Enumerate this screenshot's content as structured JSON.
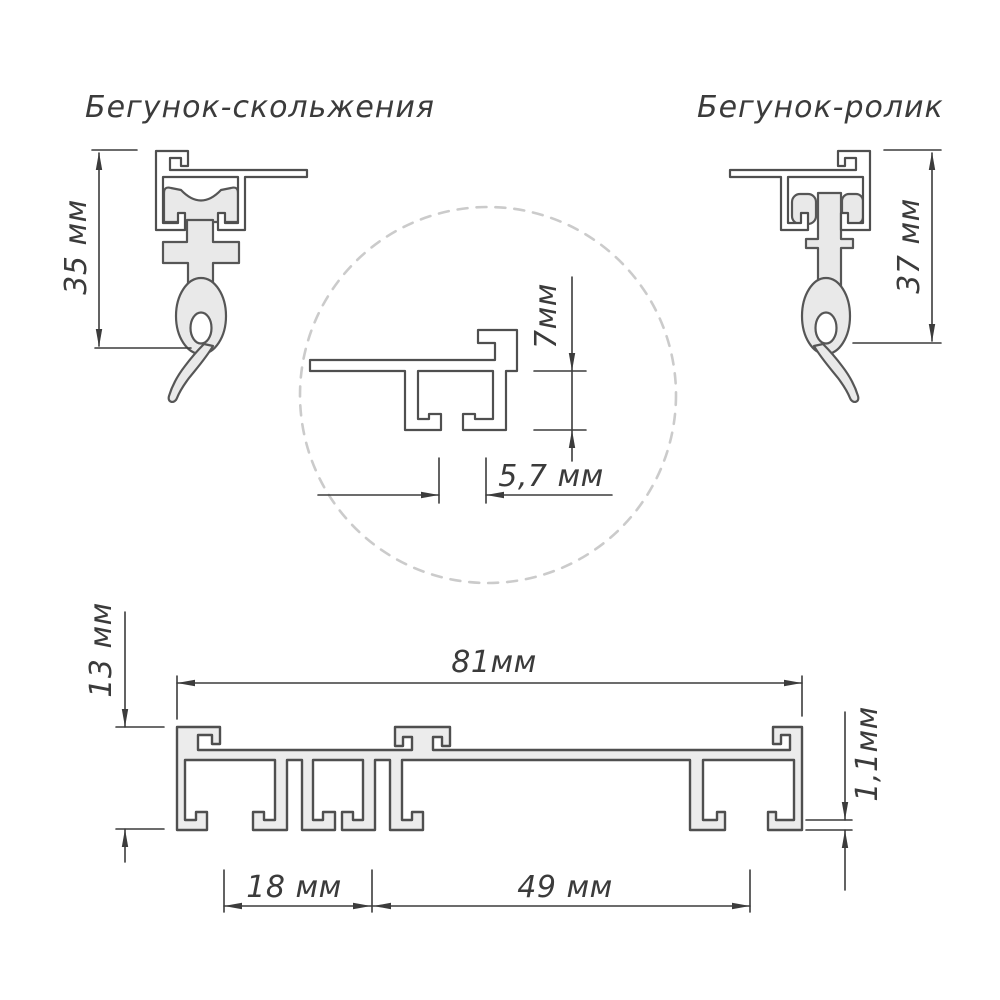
{
  "titles": {
    "slider": "Бегунок-скольжения",
    "roller": "Бегунок-ролик"
  },
  "dimensions": {
    "slider_height": "35 мм",
    "roller_height": "37 мм",
    "groove_depth": "7мм",
    "groove_slot_width": "5,7 мм",
    "profile_height": "13 мм",
    "profile_width": "81мм",
    "runner_channel_spacing": "18 мм",
    "wide_channel_spacing": "49 мм",
    "wall_thickness": "1,1мм"
  },
  "colors": {
    "background": "#ffffff",
    "drawing_outline": "#4f4f4f",
    "dimension_lines": "#3c3c3c",
    "profile_fill": "#ececec",
    "runner_fill": "#e9e9e9",
    "detail_circle": "#cbcbcb"
  }
}
